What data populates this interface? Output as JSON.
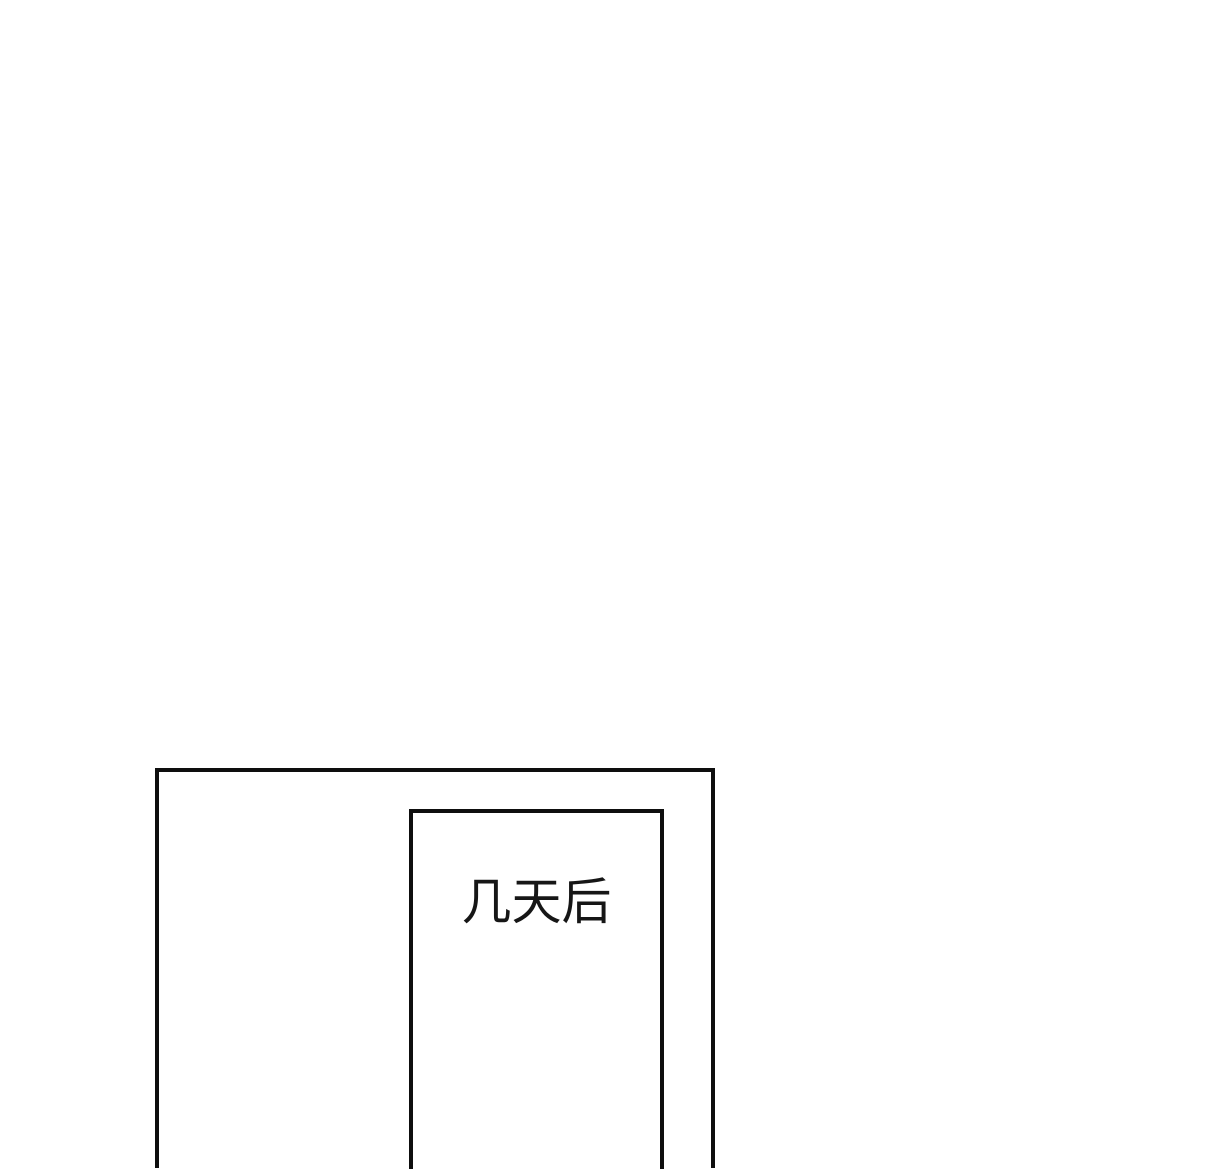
{
  "theme": {
    "page-bg": "#ffffff",
    "line-color": "#0e0e0e",
    "ink-color": "#161616"
  },
  "comic": {
    "caption": "几天后"
  }
}
